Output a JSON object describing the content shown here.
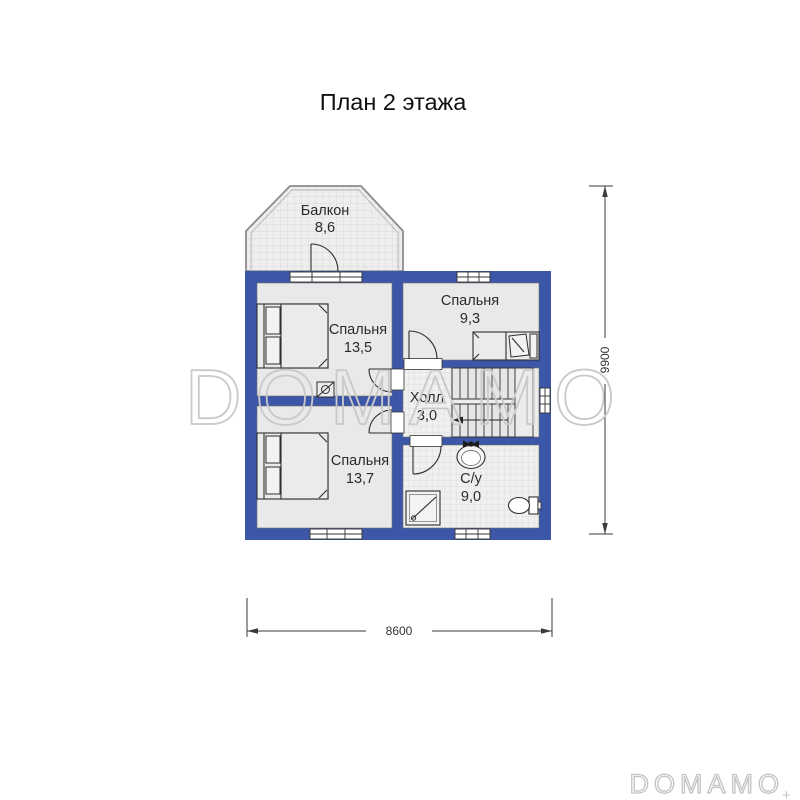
{
  "title": "План 2 этажа",
  "rooms": [
    {
      "id": "balcony",
      "name": "Балкон",
      "area": "8,6"
    },
    {
      "id": "bedroom-1",
      "name": "Спальня",
      "area": "13,5"
    },
    {
      "id": "bedroom-2",
      "name": "Спальня",
      "area": "9,3"
    },
    {
      "id": "hall",
      "name": "Холл",
      "area": "3,0"
    },
    {
      "id": "bedroom-3",
      "name": "Спальня",
      "area": "13,7"
    },
    {
      "id": "bathroom",
      "name": "С/у",
      "area": "9,0"
    }
  ],
  "dimensions": {
    "width_mm": "8600",
    "height_mm": "9900"
  },
  "watermark": {
    "center": "DOMAMO",
    "corner": "DOMAMO",
    "corner_mark": "+"
  },
  "colors": {
    "wall": "#3d57a8",
    "floor": "#e9e9e9",
    "tile": "#efefef",
    "line": "#2e2e2e",
    "watermark": "#c9c9c9"
  }
}
